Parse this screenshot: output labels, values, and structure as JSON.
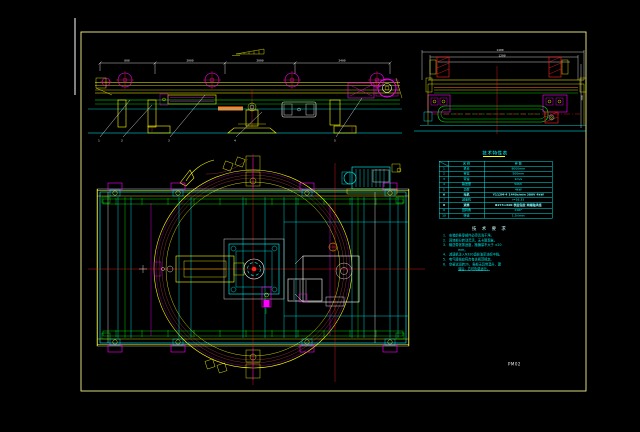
{
  "colors": {
    "background": "#000000",
    "sheet_border": "#F2F28C",
    "frame_yellow": "#FFFF00",
    "structure_cyan": "#00FFFF",
    "belt_green": "#00FF00",
    "roller_magenta": "#FF00FF",
    "centerline_red": "#FF2222",
    "ring_dark_red": "#A03838",
    "detail_orange": "#FF7F27",
    "dimension_white": "#FFFFFF"
  },
  "side_view": {
    "dim_labels": [
      "800",
      "2000",
      "2000",
      "2400"
    ],
    "balloons": [
      "1",
      "2",
      "3",
      "4",
      "5"
    ]
  },
  "end_view": {
    "dim_top": "1400",
    "dim_mid": "1200",
    "dim_right": "700"
  },
  "table": {
    "title": "技术特性表",
    "header": {
      "col2": "名 称",
      "col3": "参 数"
    },
    "rows": [
      {
        "no": "1",
        "name": "机长",
        "value": "8000mm"
      },
      {
        "no": "2",
        "name": "带宽",
        "value": "500mm"
      },
      {
        "no": "3",
        "name": "带速",
        "value": "1m/s"
      },
      {
        "no": "4",
        "name": "输送量",
        "value": "50t/h"
      },
      {
        "no": "5",
        "name": "功率",
        "value": "4kW"
      },
      {
        "no": "6",
        "name": "电机",
        "value": "Y112M-4 1440r/min 380V 4kW",
        "bold": true
      },
      {
        "no": "7",
        "name": "减速机",
        "value": "i=16.33"
      },
      {
        "no": "8",
        "name": "滚筒",
        "value": "Φ273×600 表面包胶 两端轴承座",
        "bold": true
      },
      {
        "no": "9",
        "name": "回转角",
        "value": "±90°"
      },
      {
        "no": "10",
        "name": "转速",
        "value": "1.5r/min"
      }
    ]
  },
  "notes": {
    "title": "技 术 要 求",
    "lines": [
      {
        "num": "1.",
        "text": "安装前各零部件必须清洗干净。"
      },
      {
        "num": "2.",
        "text": "回转部分转动灵活，无卡阻现象。"
      },
      {
        "num": "3.",
        "text": "输送带张紧适度，跑偏量不大于 ±20"
      },
      {
        "num": "",
        "text": "mm。",
        "indent": true
      },
      {
        "num": "4.",
        "text": "减速机注入N320齿轮油至油标中线。"
      },
      {
        "num": "5.",
        "text": "电气接线应符合有关规范规定。"
      },
      {
        "num": "6.",
        "text": "空载试运转2h，各部无异常温升、漏",
        "indent": false
      },
      {
        "num": "",
        "text": "油后，方可负载运行。",
        "indent": true,
        "underline": true
      }
    ]
  },
  "drawing_label": "PM02"
}
